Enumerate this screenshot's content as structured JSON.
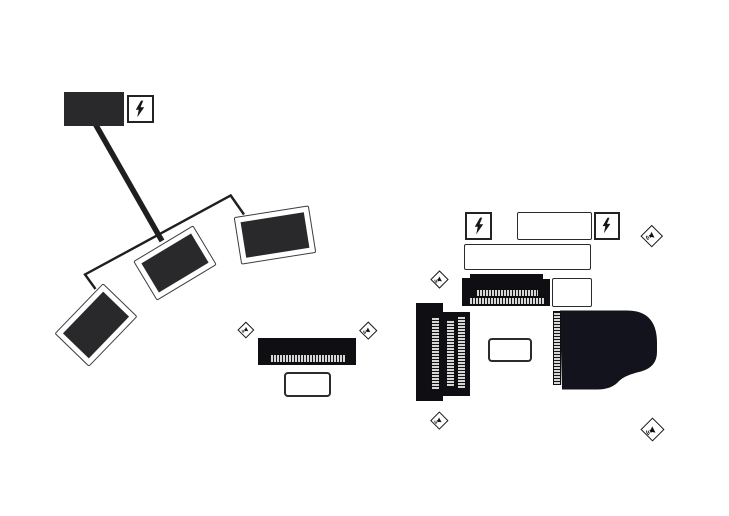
{
  "canvas": {
    "width": 729,
    "height": 516,
    "background": "#ffffff"
  },
  "palette": {
    "ink": "#1f1f1f",
    "panel_fill": "#29292b",
    "gear_fill": "#0e0e13",
    "piano_fill": "#13131d",
    "key_strip": "#d6d6d6",
    "box_fill": "#ffffff",
    "box_border": "#2b2b2b"
  },
  "icons": {
    "power": "lightning-bolt-icon",
    "monitor": "speaker-sound-waves-icon"
  },
  "stage_plot": {
    "amp_head": {
      "label": ""
    },
    "power_drops": [
      {
        "id": "power-drop-1",
        "icon": "lightning-bolt"
      },
      {
        "id": "power-drop-2",
        "icon": "lightning-bolt"
      },
      {
        "id": "power-drop-3",
        "icon": "lightning-bolt"
      }
    ],
    "cables": [
      {
        "id": "power-cable",
        "style": "thick"
      },
      {
        "id": "rig-frame-cable",
        "style": "thin"
      }
    ],
    "tilted_panels": [
      {
        "id": "tilted-panel-1",
        "rotation_deg": -46
      },
      {
        "id": "tilted-panel-2",
        "rotation_deg": -31
      },
      {
        "id": "tilted-panel-3",
        "rotation_deg": -9
      }
    ],
    "keyboards": [
      {
        "id": "keyboard-center",
        "orientation": "horizontal",
        "tiers": 1
      },
      {
        "id": "keyboard-dual-tier",
        "orientation": "horizontal",
        "tiers": 2
      },
      {
        "id": "keyboard-side-long",
        "orientation": "vertical",
        "tiers": 1
      },
      {
        "id": "keyboard-side-short",
        "orientation": "vertical",
        "tiers": 2
      }
    ],
    "grand_piano": {
      "id": "grand-piano",
      "keyboard_side": "left"
    },
    "monitor_wedges": [
      {
        "id": "monitor-wedge-center-left"
      },
      {
        "id": "monitor-wedge-center-right"
      },
      {
        "id": "monitor-wedge-top-right"
      },
      {
        "id": "monitor-wedge-mid-left"
      },
      {
        "id": "monitor-wedge-bottom-left"
      },
      {
        "id": "monitor-wedge-bottom-right"
      }
    ],
    "label_boxes": [
      {
        "id": "label-box-center",
        "text": ""
      },
      {
        "id": "label-box-piano",
        "text": ""
      }
    ],
    "blank_boxes": [
      {
        "id": "patch-box-top",
        "text": ""
      },
      {
        "id": "patch-box-wide",
        "text": ""
      },
      {
        "id": "patch-box-side",
        "text": ""
      }
    ]
  }
}
